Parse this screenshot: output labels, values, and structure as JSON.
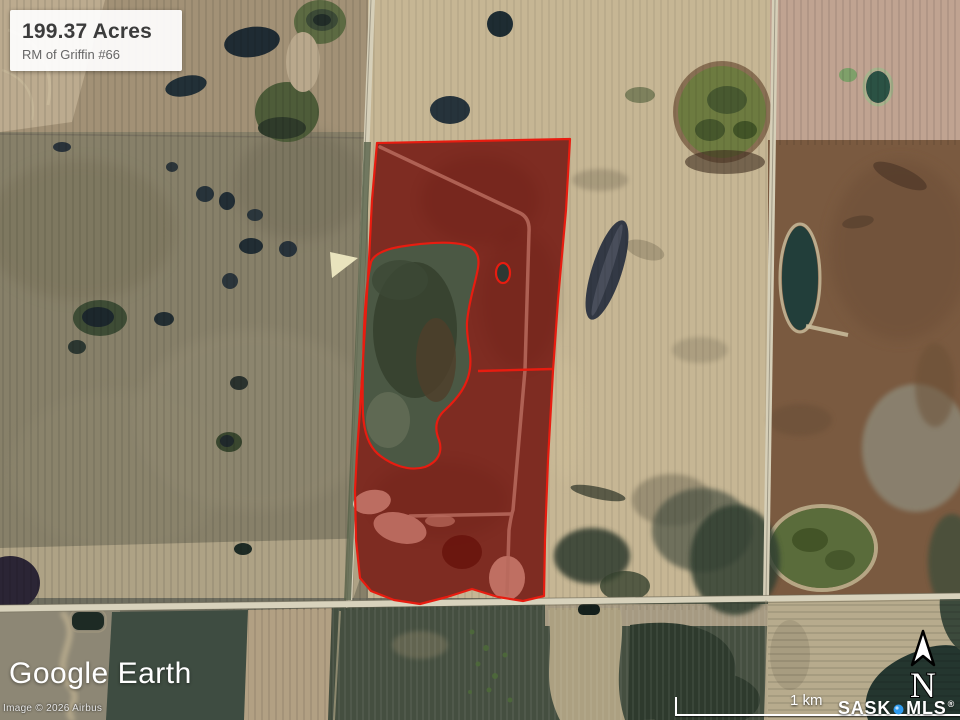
{
  "parcel_label": {
    "area": "199.37 Acres",
    "municipality": "RM of Griffin #66"
  },
  "branding": {
    "logo_text": "Google Earth",
    "copyright": "Image © 2026 Airbus"
  },
  "scale": {
    "label": "1 km"
  },
  "compass": {
    "label": "N"
  },
  "watermark": {
    "name1": "SASK",
    "name2": "MLS",
    "registered": "®"
  },
  "colors": {
    "parcel_outline": "#e81c10",
    "parcel_fill": "rgba(150,12,8,0.52)",
    "watermark_dot": "#2f9bee"
  }
}
